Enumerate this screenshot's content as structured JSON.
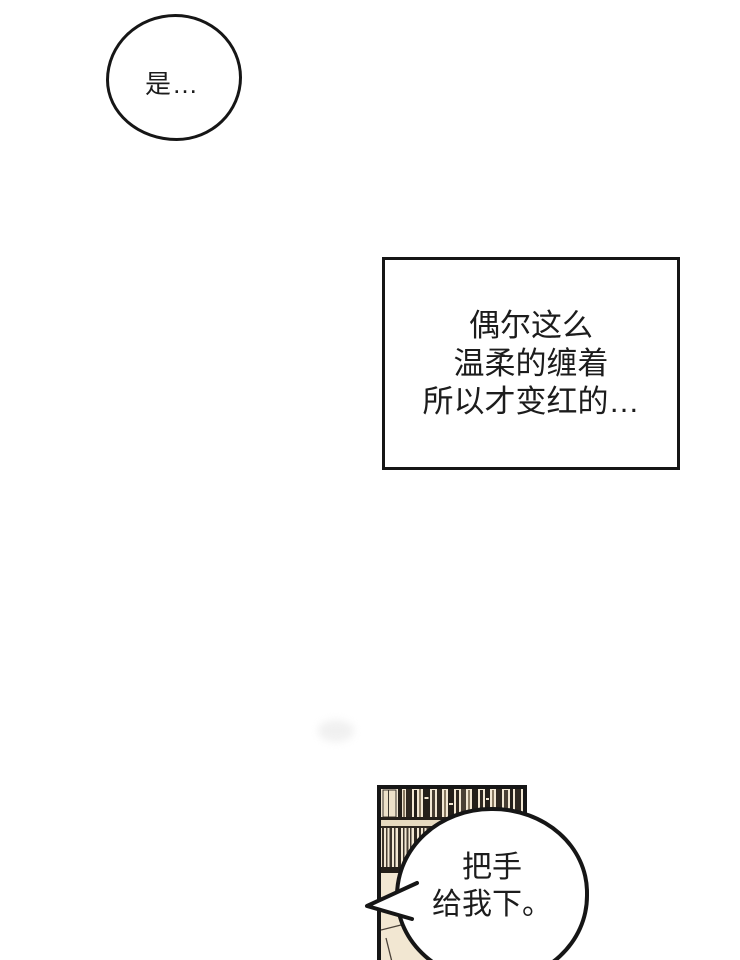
{
  "colors": {
    "paper": "#ffffff",
    "ink": "#161616",
    "text": "#1c1c1c",
    "panel_beige": "#f2e7d2",
    "shelf_beige": "#e7dabf",
    "book_dark": "#241f19",
    "book_mid": "#4a4034",
    "book_light": "#8a7b63",
    "book_deep": "#2f2820",
    "outline_soft": "#4a4138"
  },
  "bubbles": {
    "thought": {
      "text": "是…"
    },
    "caption": {
      "lines": [
        "偶尔这么",
        "温柔的缠着",
        "所以才变红的…"
      ]
    },
    "speech": {
      "lines": [
        "把手",
        "给我下。"
      ]
    }
  }
}
